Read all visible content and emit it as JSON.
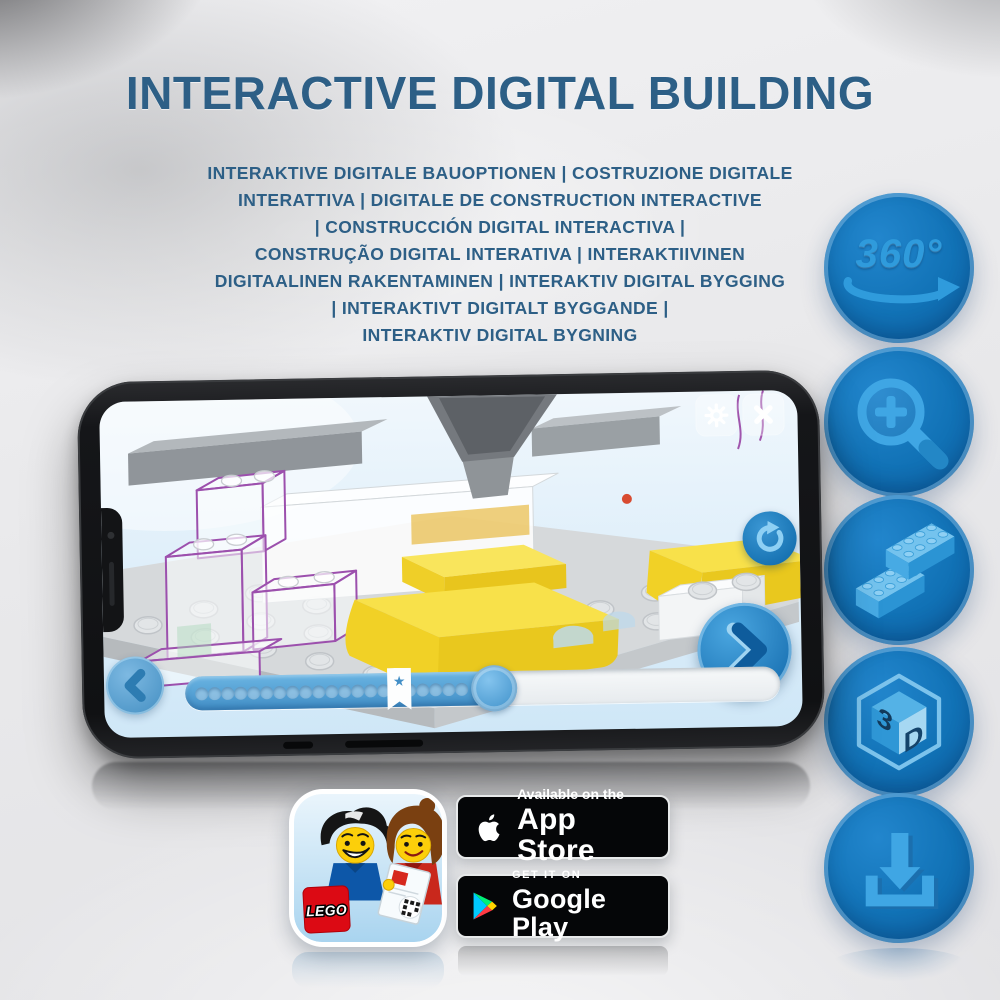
{
  "title": "INTERACTIVE DIGITAL BUILDING",
  "subtitle_lines": [
    "INTERAKTIVE DIGITALE BAUOPTIONEN | COSTRUZIONE DIGITALE",
    "INTERATTIVA | DIGITALE DE CONSTRUCTION INTERACTIVE",
    "| CONSTRUCCIÓN DIGITAL INTERACTIVA |",
    "CONSTRUÇÃO DIGITAL INTERATIVA | INTERAKTIIVINEN",
    "DIGITAALINEN RAKENTAMINEN | INTERAKTIV DIGITAL BYGGING",
    "| INTERAKTIVT DIGITALT BYGGANDE |",
    "INTERAKTIV DIGITAL BYGNING"
  ],
  "side_icons": {
    "rotation_360": {
      "label": "360°"
    },
    "cube_3d": {
      "left_face": "3",
      "right_face": "D"
    }
  },
  "phone_app": {
    "progress": {
      "dots_total": 21,
      "fill_percent": 52,
      "bookmark_percent": 36,
      "bookmark_symbol": "★"
    }
  },
  "store": {
    "app_icon": {
      "logo_text": "LEGO"
    },
    "app_store": {
      "tagline": "Available on the",
      "name": "App Store"
    },
    "google_play": {
      "tagline": "GET IT ON",
      "name": "Google Play"
    }
  },
  "colors": {
    "heading_blue": "#2d5f86",
    "icon_circle_blue": "#1172b6",
    "icon_glyph_blue": "#3fa3e0",
    "brick_yellow": "#f5d830",
    "screen_sky_blue": "#ddeefa",
    "progress_blue": "#4c9cd4",
    "background_grey": "#e9e9eb",
    "badge_black": "#050608"
  }
}
